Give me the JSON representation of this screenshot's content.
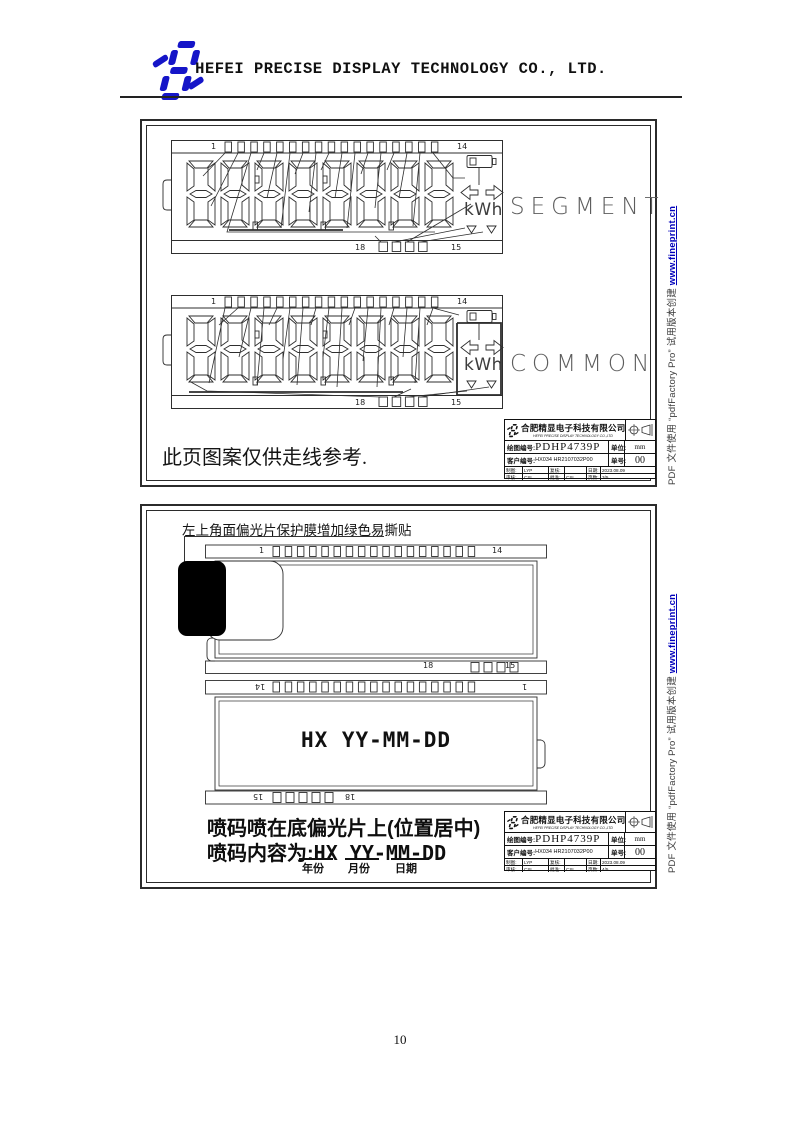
{
  "header": {
    "company": "HEFEI PRECISE DISPLAY TECHNOLOGY CO., LTD."
  },
  "frame1": {
    "note": "此页图案仅供走线参考.",
    "segment": {
      "label": "SEGMENT",
      "pin_top_left": "1",
      "pin_top_right": "14",
      "pin_bottom_left": "18",
      "pin_bottom_right": "15",
      "kwh": "kWh"
    },
    "common": {
      "label": "COMMON",
      "pin_top_left": "1",
      "pin_top_right": "14",
      "pin_bottom_left": "18",
      "pin_bottom_right": "15",
      "kwh": "kWh"
    },
    "page": "3/5"
  },
  "frame2": {
    "annotation": "左上角面偏光片保护膜增加绿色易撕贴",
    "upper": {
      "pin_top_left": "1",
      "pin_top_right": "14",
      "pin_bottom_left": "18",
      "pin_bottom_right": "15"
    },
    "lower": {
      "pin_top_left": "14",
      "pin_top_right": "1",
      "pin_bottom_left": "15",
      "pin_bottom_right": "18",
      "print_text": "HX YY-MM-DD"
    },
    "note1": "喷码喷在底偏光片上(位置居中)",
    "note2_label": "喷码内容为:",
    "note2_value": "HX YY-MM-DD",
    "date_labels": {
      "year": "年份",
      "month": "月份",
      "day": "日期"
    },
    "page": "4/5"
  },
  "titleblock": {
    "company_cn": "合肥精显电子科技有限公司",
    "company_en": "HEFEI PRECISE DISPLAY TECHNOLOGY CO.,LTD",
    "drawing_no_label": "绘图编号:",
    "drawing_no": "PDHP4739P",
    "unit_label": "单位:",
    "unit": "mm",
    "customer_no_label": "客户编号:",
    "customer_no": "HX034  HR2107032P00",
    "order_label": "单号:",
    "order": "00",
    "row1": {
      "c1": "制图:",
      "c2": "LYP",
      "c3": "复核:",
      "c4": "",
      "c5": "日期:",
      "c6": "2023.08.09"
    },
    "row2": {
      "c1": "审核:",
      "c2": "CSL",
      "c3": "批准:",
      "c4": "CSL",
      "c5": "页数:"
    }
  },
  "watermark": {
    "text": "PDF 文件使用 “pdfFactory Pro” 试用版本创建 ",
    "link": "www.fineprint.cn"
  },
  "footer": {
    "page_number": "10"
  },
  "colors": {
    "logo_blue": "#1515c8",
    "line": "#2e2e2e",
    "link_blue": "#0000bb"
  }
}
